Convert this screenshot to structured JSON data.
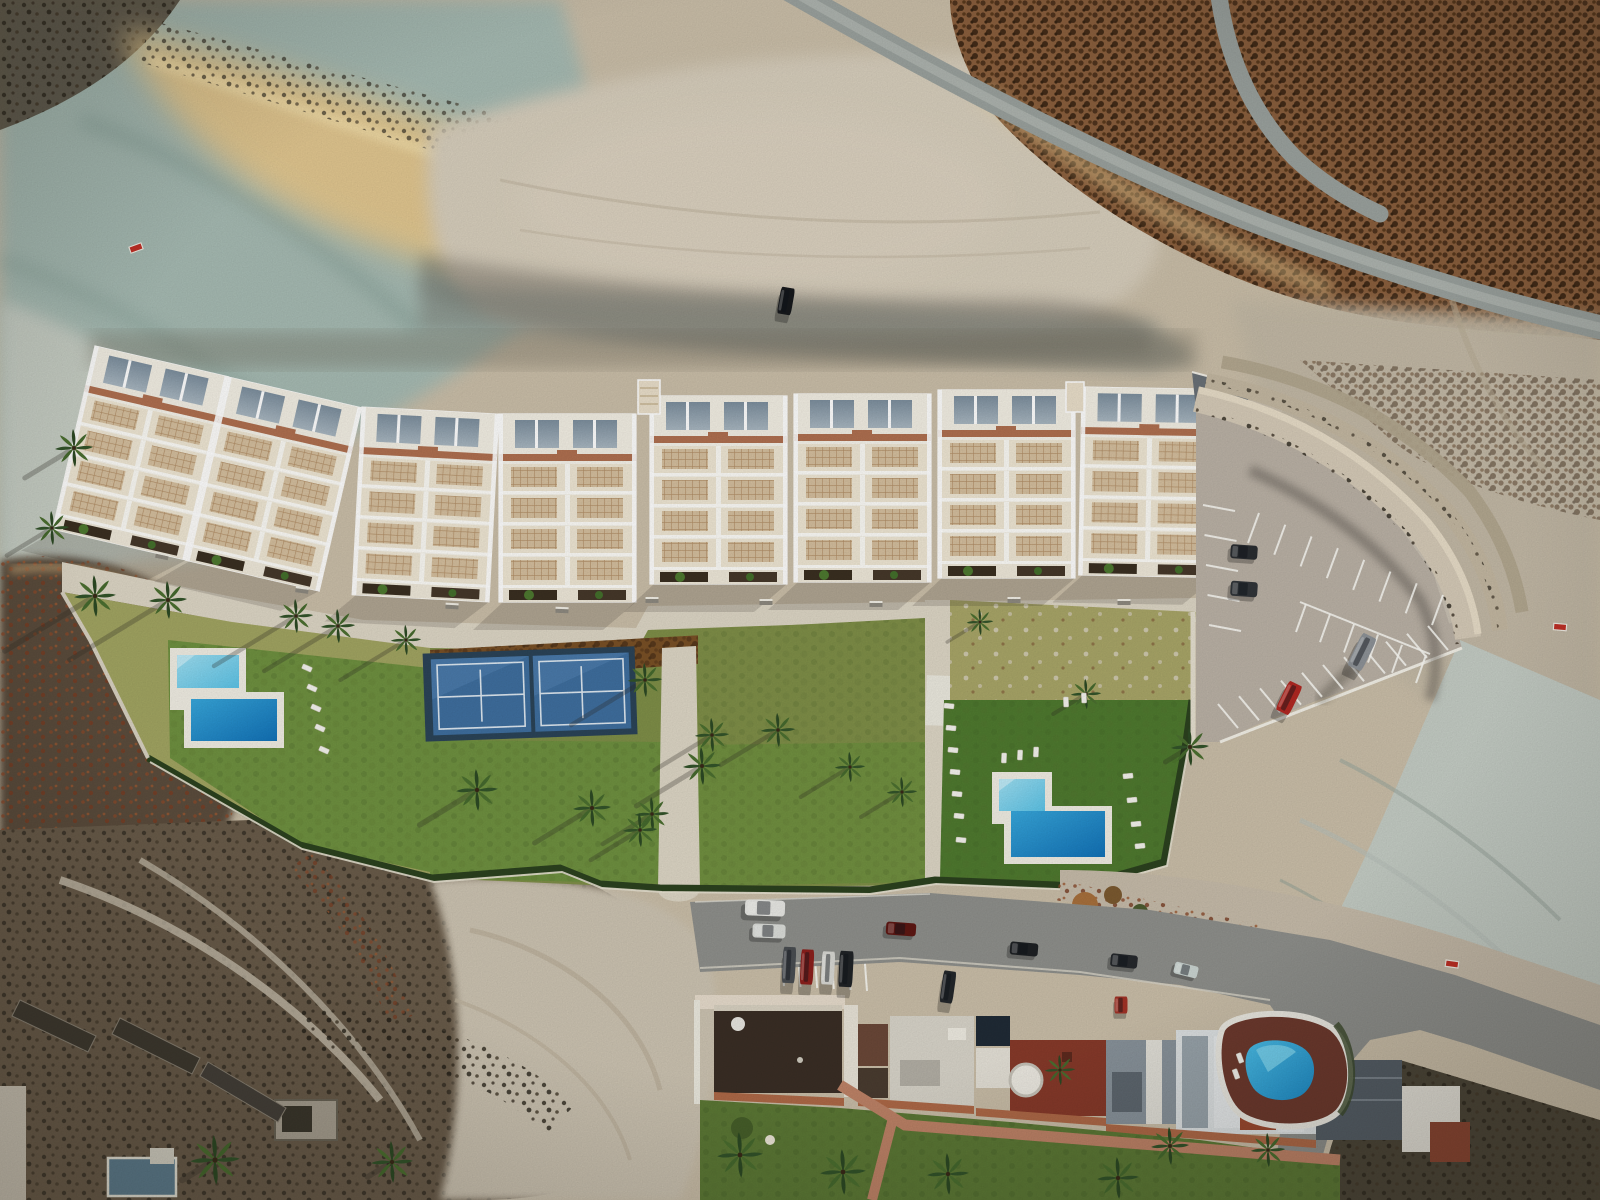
{
  "scene": {
    "description": "Aerial top-down drone view of a hillside residential development render: terraced white apartment blocks with two L-shaped pools, padel courts, lawns, palm trees and a curved parking lot, above an existing apartment row with a kidney-shaped pool, surrounded by arid scrubland and dirt tracks at sunset."
  },
  "palette": {
    "sand_base": "#cbbfa9",
    "sand_pale": "#d8cfbd",
    "sand_gold": "#e7c98e",
    "gold_bright": "#f2dda8",
    "rock_teal": "#a7bbb3",
    "rock_teal_dark": "#87a098",
    "cliff_pale": "#c5cdc5",
    "scrub_dark": "#55483a",
    "scrub_brown": "#8a5f3d",
    "scrub_deep": "#4c4638",
    "shadow": "#2e2b24",
    "road_grey": "#9ba29e",
    "asphalt": "#8f908c",
    "parking": "#bbb2a6",
    "wall_white": "#efece3",
    "path_cream": "#ded7c6",
    "bwhite": "#f6f3ea",
    "bcream": "#efe7d4",
    "terra": "#b07050",
    "lattice_tan": "#d5bf9e",
    "lattice_line": "#b28e66",
    "planter": "#3a2f21",
    "glass1": "#7d8f9e",
    "glass2": "#a9b7c1",
    "lawn_green": "#6f9140",
    "lawn_dark": "#4f7a2f",
    "lawn_dry": "#a2a562",
    "lawn_olive": "#7f8f48",
    "hedge": "#2c421f",
    "mulch": "#7a5126",
    "court_outer": "#2b4458",
    "court_in": "#3f6f9f",
    "pool_l1": "#9fe0f2",
    "pool_l2": "#5cc4e8",
    "pool_d1": "#38a8dc",
    "pool_d2": "#1272b8",
    "deck_red": "#6e3a2e",
    "pink_path": "#c08468",
    "roof_darkbrown": "#3a2e25",
    "roof_brown": "#6b4838",
    "roof_red": "#883a2a",
    "roof_grey": "#8a949c",
    "roof_slate": "#555e66",
    "roof_white": "#dfe3e4",
    "panel_navy": "#202b36",
    "sign_red": "#c23026"
  },
  "blocks": [
    {
      "x": 95,
      "y": 346,
      "r": 13
    },
    {
      "x": 228,
      "y": 377,
      "r": 13
    },
    {
      "x": 362,
      "y": 407,
      "r": 3
    },
    {
      "x": 499,
      "y": 414,
      "r": 0
    },
    {
      "x": 650,
      "y": 396,
      "r": 0
    },
    {
      "x": 794,
      "y": 394,
      "r": 0
    },
    {
      "x": 938,
      "y": 390,
      "r": 0
    },
    {
      "x": 1082,
      "y": 387,
      "r": 1
    }
  ],
  "palms": [
    {
      "x": 74,
      "y": 448,
      "s": 1.0,
      "len": 60
    },
    {
      "x": 52,
      "y": 528,
      "s": 0.9,
      "len": 55
    },
    {
      "x": 95,
      "y": 596,
      "s": 1.1,
      "len": 110
    },
    {
      "x": 168,
      "y": 600,
      "s": 1.0,
      "len": 120
    },
    {
      "x": 296,
      "y": 616,
      "s": 0.9,
      "len": 100
    },
    {
      "x": 338,
      "y": 626,
      "s": 0.9,
      "len": 90
    },
    {
      "x": 406,
      "y": 640,
      "s": 0.8,
      "len": 80
    },
    {
      "x": 645,
      "y": 680,
      "s": 0.9,
      "len": 90
    },
    {
      "x": 702,
      "y": 766,
      "s": 1.0,
      "len": 80
    },
    {
      "x": 477,
      "y": 790,
      "s": 1.1,
      "len": 70
    },
    {
      "x": 592,
      "y": 808,
      "s": 1.0,
      "len": 70
    },
    {
      "x": 652,
      "y": 814,
      "s": 0.9,
      "len": 60
    },
    {
      "x": 712,
      "y": 735,
      "s": 0.9,
      "len": 70
    },
    {
      "x": 778,
      "y": 730,
      "s": 0.9,
      "len": 70
    },
    {
      "x": 850,
      "y": 767,
      "s": 0.8,
      "len": 60
    },
    {
      "x": 902,
      "y": 792,
      "s": 0.8,
      "len": 50
    },
    {
      "x": 980,
      "y": 622,
      "s": 0.7,
      "len": 40
    },
    {
      "x": 1086,
      "y": 694,
      "s": 0.8,
      "len": 40
    },
    {
      "x": 1190,
      "y": 747,
      "s": 1.0,
      "len": 30
    },
    {
      "x": 640,
      "y": 830,
      "s": 0.9,
      "len": 60
    },
    {
      "x": 215,
      "y": 1160,
      "s": 1.3,
      "len": 40
    },
    {
      "x": 392,
      "y": 1162,
      "s": 1.1,
      "len": 30
    },
    {
      "x": 740,
      "y": 1155,
      "s": 1.2,
      "len": 30
    },
    {
      "x": 843,
      "y": 1172,
      "s": 1.2,
      "len": 30
    },
    {
      "x": 948,
      "y": 1174,
      "s": 1.1,
      "len": 30
    },
    {
      "x": 1118,
      "y": 1178,
      "s": 1.1,
      "len": 30
    },
    {
      "x": 1170,
      "y": 1146,
      "s": 1.0,
      "len": 30
    },
    {
      "x": 1268,
      "y": 1150,
      "s": 0.9,
      "len": 25
    },
    {
      "x": 1060,
      "y": 1070,
      "s": 0.8,
      "len": 25
    }
  ],
  "loungers": [
    {
      "x": 307,
      "y": 668,
      "r": 24
    },
    {
      "x": 312,
      "y": 688,
      "r": 24
    },
    {
      "x": 316,
      "y": 708,
      "r": 24
    },
    {
      "x": 320,
      "y": 728,
      "r": 24
    },
    {
      "x": 324,
      "y": 750,
      "r": 24
    },
    {
      "x": 949,
      "y": 706,
      "r": 6
    },
    {
      "x": 951,
      "y": 728,
      "r": 6
    },
    {
      "x": 953,
      "y": 750,
      "r": 6
    },
    {
      "x": 955,
      "y": 772,
      "r": 6
    },
    {
      "x": 957,
      "y": 794,
      "r": 6
    },
    {
      "x": 959,
      "y": 816,
      "r": 6
    },
    {
      "x": 961,
      "y": 840,
      "r": 6
    },
    {
      "x": 1004,
      "y": 758,
      "r": 92
    },
    {
      "x": 1020,
      "y": 755,
      "r": 92
    },
    {
      "x": 1036,
      "y": 752,
      "r": 92
    },
    {
      "x": 1066,
      "y": 702,
      "r": 88
    },
    {
      "x": 1084,
      "y": 698,
      "r": 88
    },
    {
      "x": 1128,
      "y": 776,
      "r": -6
    },
    {
      "x": 1132,
      "y": 800,
      "r": -6
    },
    {
      "x": 1136,
      "y": 824,
      "r": -6
    },
    {
      "x": 1140,
      "y": 846,
      "r": -6
    },
    {
      "x": 1240,
      "y": 1058,
      "r": 70
    },
    {
      "x": 1236,
      "y": 1074,
      "r": 70
    }
  ],
  "benches": [
    {
      "x": 162,
      "y": 556,
      "r": 12
    },
    {
      "x": 302,
      "y": 590,
      "r": 8
    },
    {
      "x": 452,
      "y": 606,
      "r": 3
    },
    {
      "x": 562,
      "y": 610,
      "r": 2
    },
    {
      "x": 652,
      "y": 600,
      "r": 0
    },
    {
      "x": 766,
      "y": 602,
      "r": 0
    },
    {
      "x": 876,
      "y": 604,
      "r": 0
    },
    {
      "x": 1014,
      "y": 600,
      "r": 0
    },
    {
      "x": 1124,
      "y": 602,
      "r": 0
    }
  ],
  "cars": [
    {
      "x": 765,
      "y": 908,
      "w": 40,
      "h": 16,
      "r": 2,
      "c": "#e9e9e5"
    },
    {
      "x": 769,
      "y": 931,
      "w": 33,
      "h": 14,
      "r": 2,
      "c": "#dcdeda"
    },
    {
      "x": 789,
      "y": 965,
      "w": 13,
      "h": 36,
      "r": 3,
      "c": "#4a4e52"
    },
    {
      "x": 807,
      "y": 967,
      "w": 13,
      "h": 35,
      "r": 3,
      "c": "#8c201c"
    },
    {
      "x": 828,
      "y": 968,
      "w": 13,
      "h": 33,
      "r": 3,
      "c": "#d9d9d4"
    },
    {
      "x": 846,
      "y": 969,
      "w": 14,
      "h": 36,
      "r": 3,
      "c": "#202326"
    },
    {
      "x": 901,
      "y": 929,
      "w": 30,
      "h": 13,
      "r": 4,
      "c": "#5e1713"
    },
    {
      "x": 948,
      "y": 987,
      "w": 13,
      "h": 32,
      "r": 8,
      "c": "#24272b"
    },
    {
      "x": 1024,
      "y": 949,
      "w": 28,
      "h": 13,
      "r": 5,
      "c": "#1e2124"
    },
    {
      "x": 1124,
      "y": 961,
      "w": 27,
      "h": 13,
      "r": 6,
      "c": "#26292d"
    },
    {
      "x": 1186,
      "y": 970,
      "w": 24,
      "h": 12,
      "r": 14,
      "c": "#ccd6d3"
    },
    {
      "x": 1121,
      "y": 1005,
      "w": 13,
      "h": 17,
      "r": 0,
      "c": "#a33226"
    },
    {
      "x": 1244,
      "y": 552,
      "w": 27,
      "h": 14,
      "r": 4,
      "c": "#2a2d31"
    },
    {
      "x": 1244,
      "y": 589,
      "w": 27,
      "h": 15,
      "r": 4,
      "c": "#313539"
    },
    {
      "x": 1289,
      "y": 698,
      "w": 15,
      "h": 32,
      "r": 26,
      "c": "#b22822"
    },
    {
      "x": 1362,
      "y": 652,
      "w": 16,
      "h": 36,
      "r": 26,
      "c": "#8e9398"
    },
    {
      "x": 786,
      "y": 301,
      "w": 14,
      "h": 27,
      "r": 10,
      "c": "#17191c"
    }
  ],
  "park_rows": [
    {
      "x1": 1248,
      "y1": 543,
      "x2": 1432,
      "y2": 625,
      "n": 8,
      "dx": 11,
      "dy": -30
    },
    {
      "x1": 1306,
      "y1": 604,
      "x2": 1426,
      "y2": 655,
      "n": 6,
      "dx": -10,
      "dy": 28
    },
    {
      "x1": 1238,
      "y1": 728,
      "x2": 1448,
      "y2": 650,
      "n": 11,
      "dx": -20,
      "dy": -24
    },
    {
      "x1": 1203,
      "y1": 505,
      "x2": 1209,
      "y2": 625,
      "n": 5,
      "dx": 32,
      "dy": 6
    },
    {
      "x1": 856,
      "y1": 899,
      "x2": 1050,
      "y2": 907,
      "n": 8,
      "dx": 2,
      "dy": 22
    },
    {
      "x1": 781,
      "y1": 946,
      "x2": 864,
      "y2": 951,
      "n": 6,
      "dx": 3,
      "dy": 40
    },
    {
      "x1": 1102,
      "y1": 944,
      "x2": 1184,
      "y2": 958,
      "n": 4,
      "dx": 5,
      "dy": 24
    },
    {
      "x1": 1240,
      "y1": 932,
      "x2": 1326,
      "y2": 950,
      "n": 4,
      "dx": 6,
      "dy": 24
    }
  ],
  "signs": [
    {
      "x": 136,
      "y": 248,
      "r": -20
    },
    {
      "x": 1560,
      "y": 627,
      "r": 5
    },
    {
      "x": 1452,
      "y": 964,
      "r": 8
    }
  ]
}
